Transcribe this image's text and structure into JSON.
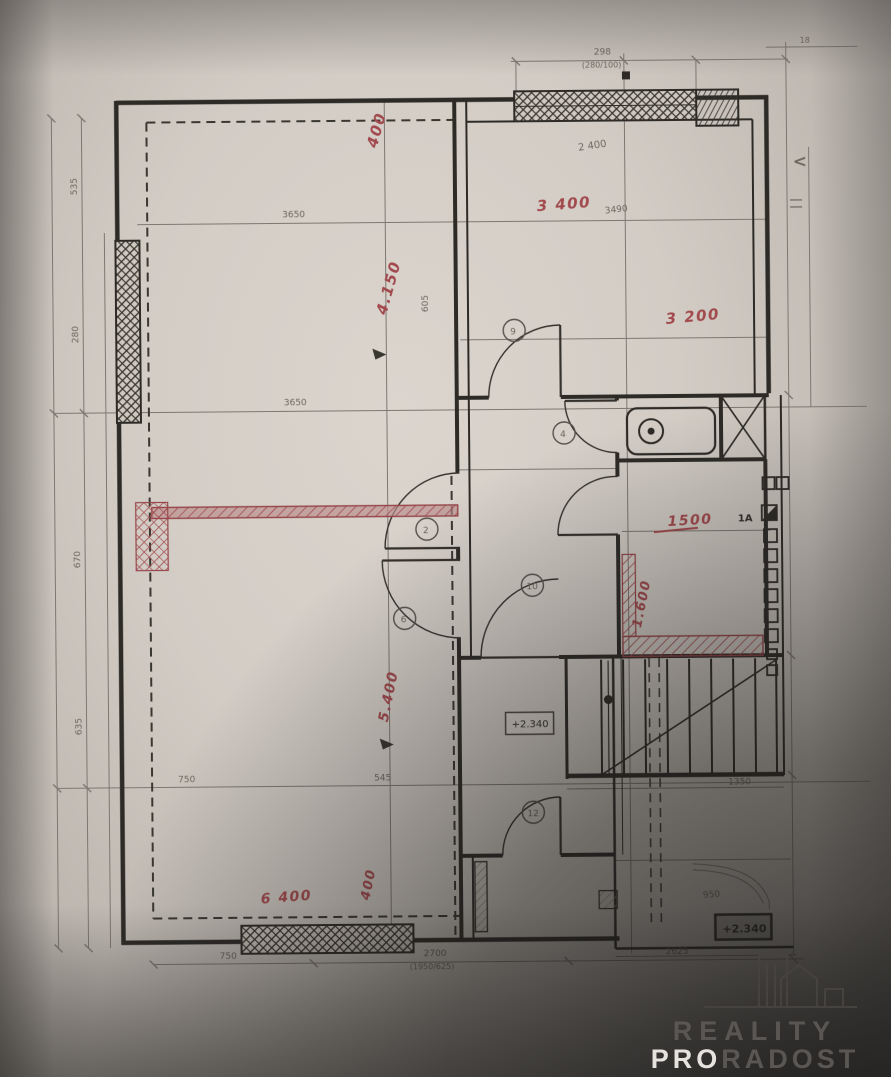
{
  "colors": {
    "ink": "#2e2b27",
    "pencil": "#6e675f",
    "red_annotation": "#a8474c",
    "paper": "#d6d0c8",
    "watermark_dark": "#5a5653",
    "watermark_light": "#e6e3de"
  },
  "watermark": {
    "brand_top": "REALITY",
    "brand_pro": "PRO",
    "brand_rest": "RADOST"
  },
  "levels": {
    "m1": "+2.340",
    "m2": "+2.340"
  },
  "labels": {
    "section": "1A"
  },
  "red": {
    "t_offset": "400",
    "tl": "4.150",
    "tr_w": "3 400",
    "tr_h": "3 200",
    "sm_w": "1500",
    "sm_h": "1.600",
    "bl_h": "5.400",
    "bl_offset": "400",
    "bl_w": "6 400"
  },
  "pencil": {
    "top_w": "298",
    "top_w_sub": "(280/100)",
    "top_right": "18",
    "tr_w": "2 400",
    "tr_w2": "3490",
    "tl_w1": "3650",
    "tl_w2": "3650",
    "left1": "535",
    "left2": "280",
    "left3": "670",
    "left4": "635",
    "mid_v": "605",
    "bl_w1": "750",
    "bl_w2": "545",
    "bottom1": "750",
    "bottom2": "2700",
    "bottom2_sub": "(1950/625)",
    "bottom3": "2625",
    "stairs": "1350",
    "landing": "950",
    "chevron": "<"
  },
  "doors": [
    "9",
    "4",
    "2",
    "6",
    "10",
    "12"
  ]
}
